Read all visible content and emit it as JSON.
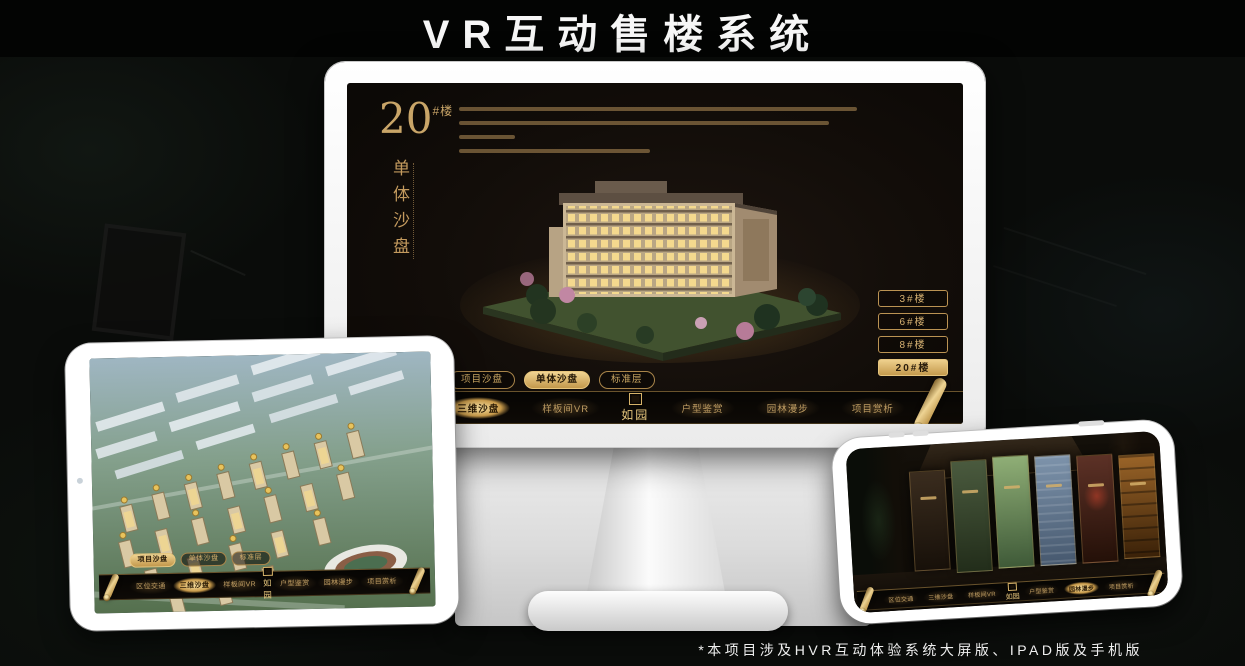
{
  "title": "VR互动售楼系统",
  "footnote": "*本项目涉及HVR互动体验系统大屏版、IPAD版及手机版",
  "colors": {
    "accent_gold": "#c9a568",
    "accent_gold_bright": "#eed08d",
    "screen_bg": "#120d09",
    "title_text": "#f7f7f7"
  },
  "icons": {
    "logo_seal": "seal-icon",
    "nav_end": "scroll-icon",
    "tablet_camera": "camera-dot-icon",
    "phone_camera": "camera-dot-icon"
  },
  "nav": {
    "logo": "如园",
    "items": [
      "区位交通",
      "三维沙盘",
      "样板间VR",
      "户型鉴赏",
      "园林漫步",
      "项目赏析"
    ]
  },
  "sub_tabs": [
    "项目沙盘",
    "单体沙盘",
    "标准层"
  ],
  "monitor": {
    "header_number": "20",
    "header_suffix": "#楼",
    "header_subtitle": "单体沙盘",
    "floor_buttons": [
      "3#楼",
      "6#楼",
      "8#楼",
      "20#楼"
    ],
    "active_floor_button": "20#楼",
    "active_sub_tab": "单体沙盘",
    "active_nav_item": "三维沙盘"
  },
  "ipad": {
    "active_sub_tab": "项目沙盘",
    "active_nav_item": "三维沙盘"
  },
  "phone": {
    "active_nav_item": "园林漫步"
  }
}
